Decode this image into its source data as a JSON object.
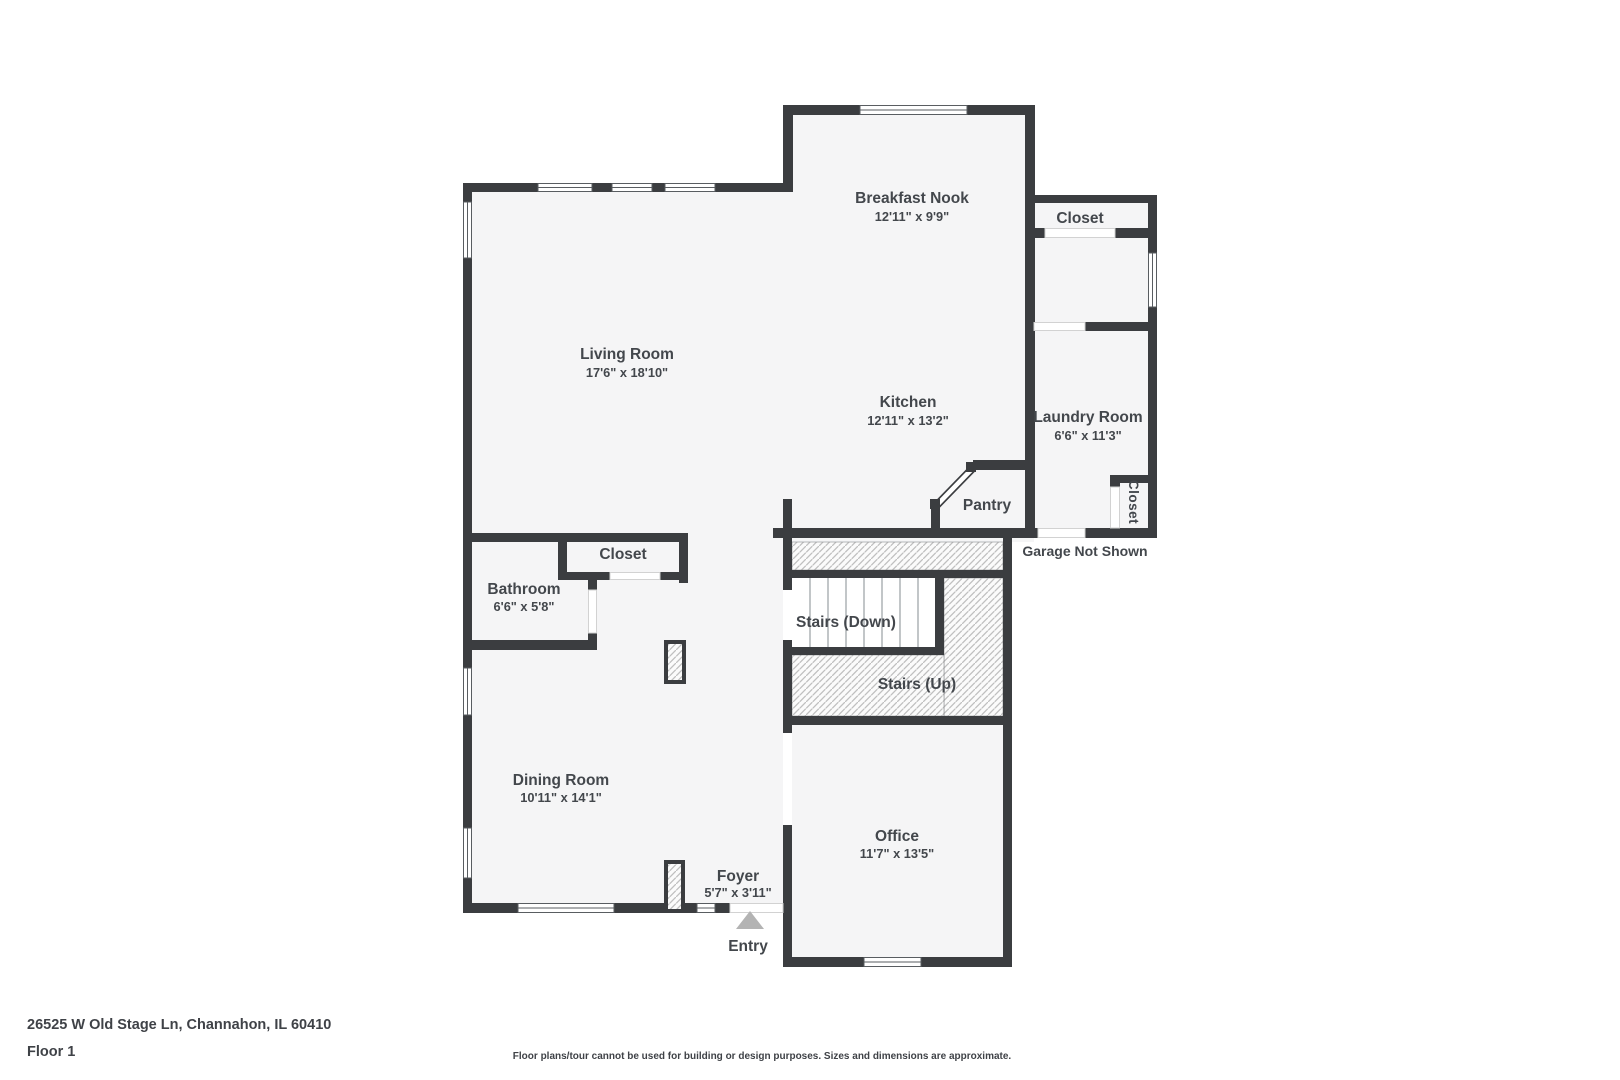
{
  "plan": {
    "rooms": {
      "breakfast_nook": {
        "name": "Breakfast Nook",
        "dims": "12'11\" x 9'9\""
      },
      "closet_upper": {
        "name": "Closet"
      },
      "living_room": {
        "name": "Living Room",
        "dims": "17'6\" x 18'10\""
      },
      "kitchen": {
        "name": "Kitchen",
        "dims": "12'11\" x 13'2\""
      },
      "laundry_room": {
        "name": "Laundry Room",
        "dims": "6'6\" x 11'3\""
      },
      "pantry": {
        "name": "Pantry"
      },
      "laundry_closet": {
        "name": "Closet"
      },
      "hall_closet": {
        "name": "Closet"
      },
      "bathroom": {
        "name": "Bathroom",
        "dims": "6'6\" x 5'8\""
      },
      "stairs_down": {
        "name": "Stairs (Down)"
      },
      "stairs_up": {
        "name": "Stairs (Up)"
      },
      "dining_room": {
        "name": "Dining Room",
        "dims": "10'11\" x 14'1\""
      },
      "office": {
        "name": "Office",
        "dims": "11'7\" x 13'5\""
      },
      "foyer": {
        "name": "Foyer",
        "dims": "5'7\" x 3'11\""
      },
      "entry": {
        "name": "Entry"
      }
    },
    "notes": {
      "garage": "Garage Not Shown"
    },
    "colors": {
      "wall": "#3b3d40",
      "floor": "#f5f5f6",
      "text": "#43474c",
      "entry_arrow": "#b3b3b3",
      "hatch_line": "#bfbfbf"
    }
  },
  "footer": {
    "address": "26525 W Old Stage Ln, Channahon, IL 60410",
    "floor_label": "Floor 1",
    "disclaimer": "Floor plans/tour cannot be used for building or design purposes. Sizes and dimensions are approximate."
  }
}
